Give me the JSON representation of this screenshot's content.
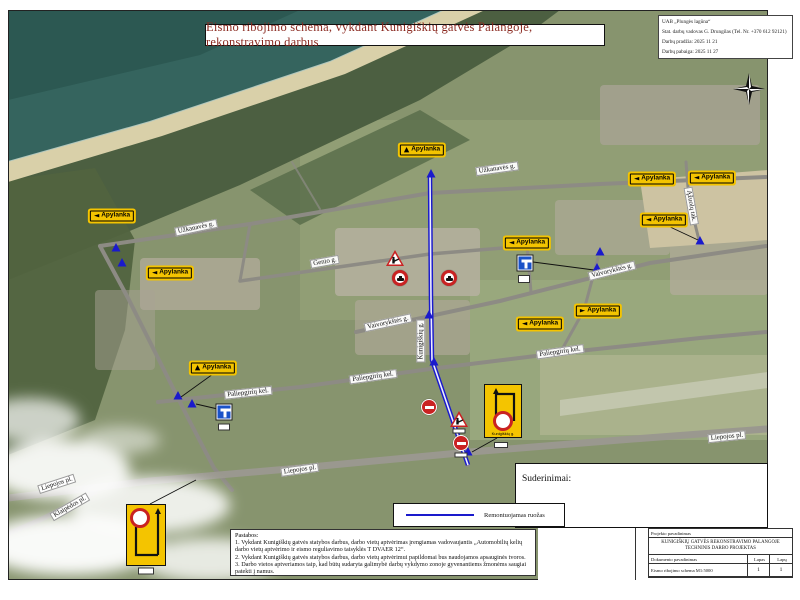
{
  "header": {
    "title": "Eismo ribojimo schema, vykdant Kunigiškių gatvės Palangoje, rekonstravimo darbus"
  },
  "contractor_box": {
    "company": "UAB „Plungės lagūna“",
    "manager": "Stat. darbų vadovas G. Drungilas (Tel. Nr. +370 612 92121)",
    "start": "Darbų pradžia: 2025 11 21",
    "end": "Darbų pabaiga: 2025 11 27"
  },
  "legend": {
    "label": "Remontuojamas ruožas",
    "line_color": "#1a1acc"
  },
  "approvals": {
    "label": "Suderinimai:"
  },
  "notes": {
    "heading": "Pastabos:",
    "item1": "1. Vykdant Kunigiškių gatvės statybos darbus, darbo vietų aptvėrimas įrengiamas vadovaujantis „Automobilių kelių darbo vietų aptvėrimo ir eismo reguliavimo taisyklės T DVAER 12“.",
    "item2": "2. Vykdant Kunigiškių gatvės statybos darbus, darbo vietų aptvėrimui papildomai bus naudojamos apsauginės tvoros.",
    "item3": "3. Darbo vietos aptveriamos taip, kad būtų sudaryta galimybė darbų vykdymo zonoje gyvenantiems žmonėms saugiai patekti į namus."
  },
  "title_block": {
    "project_label": "Projekto pavadinimas",
    "project_name": "KUNIGIŠKIŲ GATVĖS REKONSTRAVIMO PALANGOJE TECHNINIS DARBO PROJEKTAS",
    "document_label": "Dokumento pavadinimas",
    "document_name": "Eismo ribojimo schema M1:5000",
    "sheet_label": "Lapas",
    "sheets_label": "Lapų",
    "sheet_value": "1",
    "sheets_value": "1"
  },
  "map": {
    "colors": {
      "route_blue": "#1a1acc",
      "detour_yellow": "#f4c400",
      "prohibit_red": "#c92222",
      "deadend_blue": "#1a52c8",
      "title_red": "#8b2a21"
    },
    "street_labels": [
      {
        "text": "Užkanavės g."
      },
      {
        "text": "Užkanavės g."
      },
      {
        "text": "Genio g."
      },
      {
        "text": "Vaivorykštės g."
      },
      {
        "text": "Vaivorykštės g."
      },
      {
        "text": "Kunigiškių g."
      },
      {
        "text": "Ąžuolų tak."
      },
      {
        "text": "Paliepgirių kel."
      },
      {
        "text": "Paliepgirių kel."
      },
      {
        "text": "Paliepgirių kel."
      },
      {
        "text": "Liepojos pl."
      },
      {
        "text": "Liepojos pl."
      },
      {
        "text": "Liepojos pl."
      },
      {
        "text": "Klaipėdos pl."
      }
    ],
    "detour_signs": [
      {
        "label": "Apylanka",
        "arrow": "▲"
      },
      {
        "label": "Apylanka",
        "arrow": "◄"
      },
      {
        "label": "Apylanka",
        "arrow": "◄"
      },
      {
        "label": "Apylanka",
        "arrow": "◄"
      },
      {
        "label": "Apylanka",
        "arrow": "◄"
      },
      {
        "label": "Apylanka",
        "arrow": "◄"
      },
      {
        "label": "Apylanka",
        "arrow": "◄"
      },
      {
        "label": "Apylanka",
        "arrow": "►"
      },
      {
        "label": "Apylanka",
        "arrow": "◄"
      },
      {
        "label": "Apylanka",
        "arrow": "▲"
      }
    ],
    "detour_board_label": "Kunigiškių g."
  }
}
